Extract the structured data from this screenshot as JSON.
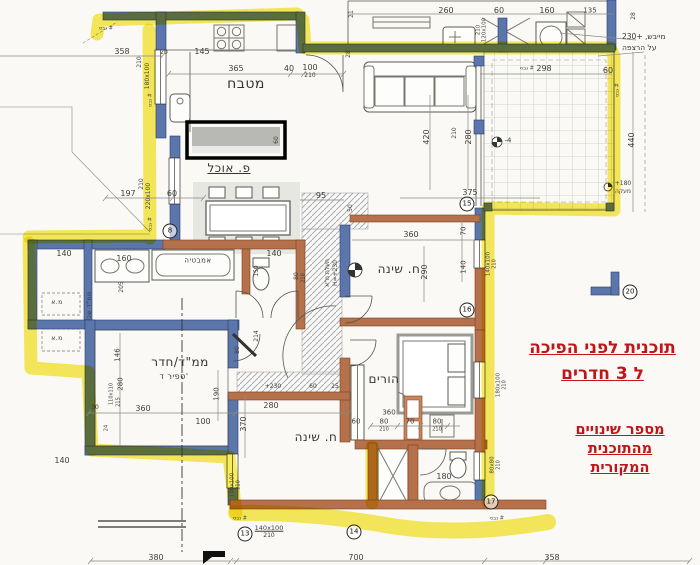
{
  "annotations": {
    "title_line1": "תוכנית לפני הפיכה",
    "title_line2": "ל 3 חדרים",
    "note_line1": "מספר שינויים",
    "note_line2": "מהתוכנית",
    "note_line3": "המקורית",
    "dryer_line1": "מייבש, +230",
    "dryer_line2": "על הרצפה",
    "accent_color": "#c0151a",
    "highlight_color": "#f6e62e"
  },
  "room_labels": [
    {
      "t": "מטבח",
      "x": 246,
      "y": 84,
      "s": 14
    },
    {
      "t": "פ. אוכל",
      "x": 229,
      "y": 168,
      "s": 12,
      "u": true
    },
    {
      "t": "ח. שינה",
      "x": 399,
      "y": 269,
      "s": 12
    },
    {
      "t": "ח. שינה",
      "x": 316,
      "y": 437,
      "s": 12
    },
    {
      "t": "הורים",
      "x": 384,
      "y": 379,
      "s": 12
    },
    {
      "t": "ממ\"ד/חדר",
      "x": 180,
      "y": 362,
      "s": 12
    },
    {
      "t": "ספיר ד'",
      "x": 174,
      "y": 377,
      "s": 8
    },
    {
      "t": "אמבטיה",
      "x": 198,
      "y": 261,
      "s": 7
    },
    {
      "t": "מ.א",
      "x": 57,
      "y": 303,
      "s": 6
    },
    {
      "t": "מ.א",
      "x": 57,
      "y": 339,
      "s": 6
    },
    {
      "t": "ממ\"ד שכן",
      "x": 90,
      "y": 306,
      "r": -90,
      "s": 6
    }
  ],
  "dim_labels": [
    {
      "t": "358",
      "x": 122,
      "y": 52
    },
    {
      "t": "145",
      "x": 202,
      "y": 52
    },
    {
      "t": "20",
      "x": 164,
      "y": 53,
      "s": 6
    },
    {
      "t": "365",
      "x": 236,
      "y": 69
    },
    {
      "t": "40",
      "x": 289,
      "y": 69
    },
    {
      "t": "100",
      "x": 310,
      "y": 68
    },
    {
      "t": "210",
      "x": 310,
      "y": 76,
      "s": 6
    },
    {
      "t": "210",
      "x": 140,
      "y": 62,
      "r": -90,
      "s": 6
    },
    {
      "t": "180x100",
      "x": 148,
      "y": 76,
      "r": -90,
      "s": 6
    },
    {
      "t": "210",
      "x": 142,
      "y": 184,
      "r": -90,
      "s": 6
    },
    {
      "t": "220x100",
      "x": 149,
      "y": 196,
      "r": -90,
      "s": 6
    },
    {
      "t": "197",
      "x": 128,
      "y": 194
    },
    {
      "t": "60",
      "x": 172,
      "y": 194
    },
    {
      "t": "95",
      "x": 321,
      "y": 196
    },
    {
      "t": "50",
      "x": 351,
      "y": 208,
      "r": -90,
      "s": 6
    },
    {
      "t": "375",
      "x": 470,
      "y": 193
    },
    {
      "t": "420",
      "x": 427,
      "y": 137,
      "r": -90
    },
    {
      "t": "210",
      "x": 455,
      "y": 133,
      "r": -90,
      "s": 6
    },
    {
      "t": "280",
      "x": 469,
      "y": 137,
      "r": -90
    },
    {
      "t": "260",
      "x": 446,
      "y": 11
    },
    {
      "t": "60",
      "x": 499,
      "y": 11
    },
    {
      "t": "160",
      "x": 547,
      "y": 11
    },
    {
      "t": "135",
      "x": 590,
      "y": 11,
      "s": 7
    },
    {
      "t": "28",
      "x": 634,
      "y": 16,
      "r": -90,
      "s": 6
    },
    {
      "t": "21",
      "x": 352,
      "y": 14,
      "r": -90,
      "s": 6
    },
    {
      "t": "28",
      "x": 349,
      "y": 54,
      "r": -90,
      "s": 6
    },
    {
      "t": "120x100",
      "x": 485,
      "y": 30,
      "r": -90,
      "s": 5.5
    },
    {
      "t": "210",
      "x": 479,
      "y": 30,
      "r": -90,
      "s": 5.5
    },
    {
      "t": "298",
      "x": 544,
      "y": 69
    },
    {
      "t": "60",
      "x": 608,
      "y": 71
    },
    {
      "t": "440",
      "x": 632,
      "y": 140,
      "r": -90
    },
    {
      "t": "+180",
      "x": 623,
      "y": 184,
      "s": 6
    },
    {
      "t": "מעקה",
      "x": 623,
      "y": 192,
      "s": 6
    },
    {
      "t": "-4",
      "x": 508,
      "y": 141,
      "s": 7
    },
    {
      "t": "60",
      "x": 277,
      "y": 140,
      "r": -90,
      "s": 6
    },
    {
      "t": "140",
      "x": 64,
      "y": 254
    },
    {
      "t": "160",
      "x": 124,
      "y": 259
    },
    {
      "t": "205",
      "x": 122,
      "y": 287,
      "r": -90,
      "s": 6
    },
    {
      "t": "140",
      "x": 274,
      "y": 254
    },
    {
      "t": "150",
      "x": 257,
      "y": 271,
      "r": -90,
      "s": 6
    },
    {
      "t": "80",
      "x": 297,
      "y": 276,
      "r": -90,
      "s": 6
    },
    {
      "t": "210",
      "x": 304,
      "y": 278,
      "r": -90,
      "s": 5
    },
    {
      "t": "תעלת מ\"א",
      "x": 328,
      "y": 273,
      "r": -90,
      "s": 6
    },
    {
      "t": "H=+230",
      "x": 336,
      "y": 273,
      "r": -90,
      "s": 6
    },
    {
      "t": "214",
      "x": 257,
      "y": 336,
      "r": -90,
      "s": 6
    },
    {
      "t": "80",
      "x": 238,
      "y": 350,
      "r": -90,
      "s": 6
    },
    {
      "t": "+230",
      "x": 273,
      "y": 387,
      "s": 6
    },
    {
      "t": "60",
      "x": 313,
      "y": 387,
      "s": 6
    },
    {
      "t": "25",
      "x": 335,
      "y": 387,
      "s": 6
    },
    {
      "t": "360",
      "x": 411,
      "y": 235
    },
    {
      "t": "70",
      "x": 464,
      "y": 231,
      "r": -90,
      "s": 7
    },
    {
      "t": "290",
      "x": 425,
      "y": 272,
      "r": -90
    },
    {
      "t": "140",
      "x": 464,
      "y": 267,
      "r": -90,
      "s": 7
    },
    {
      "t": "140x100",
      "x": 489,
      "y": 264,
      "r": -90,
      "s": 5.5
    },
    {
      "t": "210",
      "x": 495,
      "y": 264,
      "r": -90,
      "s": 5
    },
    {
      "t": "146",
      "x": 118,
      "y": 355,
      "r": -90,
      "s": 7
    },
    {
      "t": "280",
      "x": 121,
      "y": 384,
      "r": -90,
      "s": 7
    },
    {
      "t": "110x110",
      "x": 112,
      "y": 394,
      "r": -90,
      "s": 5
    },
    {
      "t": "215",
      "x": 119,
      "y": 402,
      "r": -90,
      "s": 5
    },
    {
      "t": "30",
      "x": 95,
      "y": 408,
      "s": 6
    },
    {
      "t": "24",
      "x": 107,
      "y": 428,
      "r": -90,
      "s": 5
    },
    {
      "t": "360",
      "x": 143,
      "y": 409
    },
    {
      "t": "100",
      "x": 203,
      "y": 422
    },
    {
      "t": "190",
      "x": 217,
      "y": 394,
      "r": -90,
      "s": 7
    },
    {
      "t": "140",
      "x": 62,
      "y": 461
    },
    {
      "t": "380",
      "x": 156,
      "y": 558
    },
    {
      "t": "280",
      "x": 271,
      "y": 406
    },
    {
      "t": "370",
      "x": 244,
      "y": 424,
      "r": -90
    },
    {
      "t": "60",
      "x": 356,
      "y": 422,
      "s": 7
    },
    {
      "t": "80",
      "x": 384,
      "y": 422,
      "s": 7
    },
    {
      "t": "70",
      "x": 410,
      "y": 422,
      "s": 7
    },
    {
      "t": "80",
      "x": 437,
      "y": 422,
      "s": 7
    },
    {
      "t": "210",
      "x": 384,
      "y": 430,
      "s": 5
    },
    {
      "t": "210",
      "x": 437,
      "y": 430,
      "s": 5
    },
    {
      "t": "360",
      "x": 389,
      "y": 413,
      "s": 7
    },
    {
      "t": "180",
      "x": 444,
      "y": 477
    },
    {
      "t": "180x100",
      "x": 499,
      "y": 385,
      "r": -90,
      "s": 5.5
    },
    {
      "t": "210",
      "x": 505,
      "y": 385,
      "r": -90,
      "s": 5
    },
    {
      "t": "80x80",
      "x": 493,
      "y": 465,
      "r": -90,
      "s": 5.5
    },
    {
      "t": "210",
      "x": 499,
      "y": 465,
      "r": -90,
      "s": 5
    },
    {
      "t": "100x100",
      "x": 233,
      "y": 485,
      "r": -90,
      "s": 5.5
    },
    {
      "t": "210",
      "x": 239,
      "y": 485,
      "r": -90,
      "s": 5
    },
    {
      "t": "140x100",
      "x": 269,
      "y": 528,
      "s": 6.5,
      "u": true
    },
    {
      "t": "210",
      "x": 269,
      "y": 536,
      "s": 6
    },
    {
      "t": "700",
      "x": 356,
      "y": 558
    },
    {
      "t": "358",
      "x": 552,
      "y": 558
    },
    {
      "t": "גבס #",
      "x": 106,
      "y": 29,
      "s": 5,
      "c": "#4a4a44"
    },
    {
      "t": "גבס #",
      "x": 151,
      "y": 100,
      "r": -90,
      "s": 5,
      "c": "#4a4a44"
    },
    {
      "t": "גבס #",
      "x": 151,
      "y": 224,
      "r": -90,
      "s": 5,
      "c": "#4a4a44"
    },
    {
      "t": "גבס #",
      "x": 240,
      "y": 519,
      "s": 5,
      "c": "#4a4a44"
    },
    {
      "t": "גבס #",
      "x": 497,
      "y": 519,
      "s": 5,
      "c": "#4a4a44"
    },
    {
      "t": "גבס #",
      "x": 618,
      "y": 90,
      "r": -90,
      "s": 5,
      "c": "#4a4a44"
    },
    {
      "t": "גבס #",
      "x": 527,
      "y": 69,
      "s": 5,
      "c": "#4a4a44"
    }
  ],
  "markers": [
    {
      "t": "8",
      "x": 170,
      "y": 231
    },
    {
      "t": "13",
      "x": 245,
      "y": 534
    },
    {
      "t": "14",
      "x": 354,
      "y": 532
    },
    {
      "t": "17",
      "x": 491,
      "y": 502
    },
    {
      "t": "20",
      "x": 630,
      "y": 292
    },
    {
      "t": "15",
      "x": 467,
      "y": 204
    },
    {
      "t": "16",
      "x": 467,
      "y": 310
    }
  ]
}
